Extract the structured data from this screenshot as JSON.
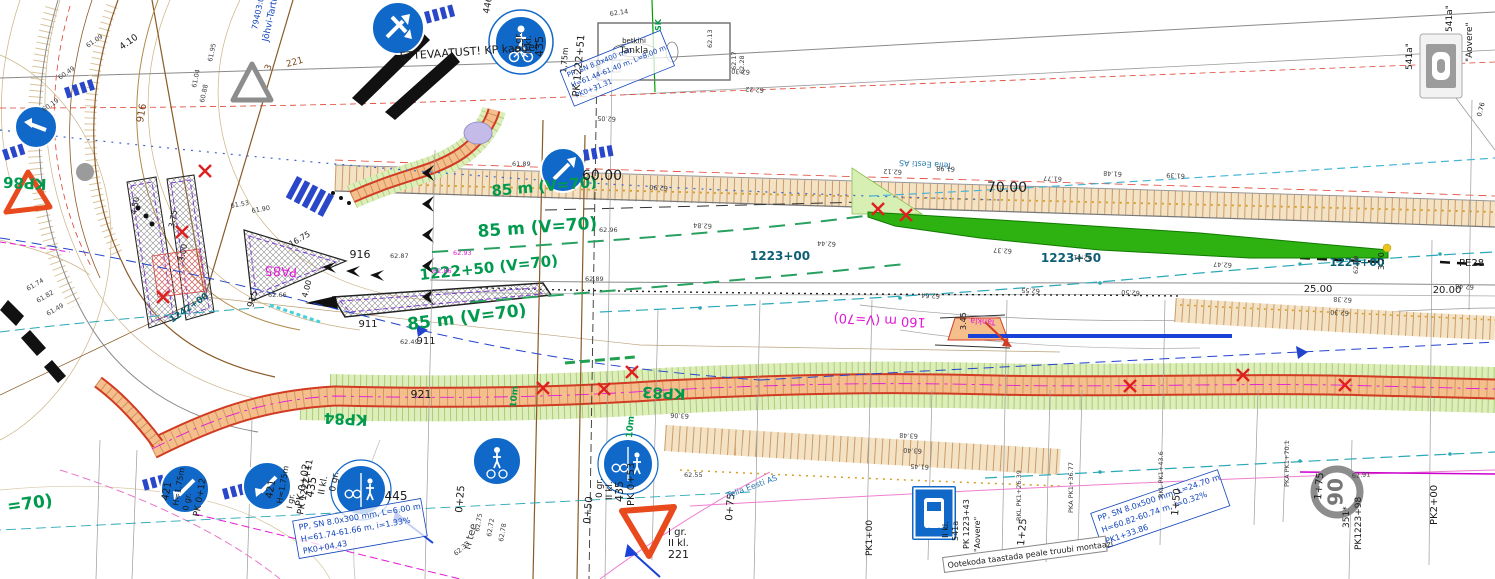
{
  "notes": {
    "caution_cable": "ETTEVAATUST! KP kaabel",
    "shelter": "Ootekoda taastada peale truubi montaazi",
    "gas_station_small": "betkini",
    "gas_station": "Tankla",
    "gas_station_inv": "Tankla",
    "road_name": "Jõhvi-Tartu-Valga",
    "cadastral_no": "79403:002:0",
    "street_fragment": "ri tee",
    "telia": "Telia Eesti AS",
    "sk_mark": "SK"
  },
  "curve_labels": [
    "85 m (V=70)",
    "85 m (V=70)",
    "1222+50 (V=70)",
    "85 m (V=70)",
    "160 m (V=70)",
    "=70)"
  ],
  "stations": {
    "a": "1223+00",
    "b": "1223+50",
    "c": "1224+00",
    "d": "1242+00",
    "pe28": "PE28"
  },
  "distances": {
    "d60": "60.00",
    "d70": "70.00",
    "d25": "25.00",
    "d20": "20.00"
  },
  "chainage": [
    "0+25",
    "0+50",
    "0+75",
    "1+25",
    "1+50",
    "1+75",
    "PK1+00",
    "PK2+00",
    "PK 1222+51"
  ],
  "km_posts": [
    "KP84",
    "KP83",
    "PA85",
    "KP86"
  ],
  "codes": [
    "916",
    "911",
    "915",
    "921",
    "911",
    "916",
    "446",
    "3",
    "221"
  ],
  "dims": [
    "4.10",
    "16.75",
    "4.00",
    "3.75",
    "4.50",
    "3.00",
    "3.45",
    "3.70",
    "10m",
    "10m",
    "1,75m",
    "0.76"
  ],
  "signs": {
    "s421_a": [
      "421",
      "H=1.75m",
      "0 gr.",
      "PK 0+12"
    ],
    "s421_b": [
      "421",
      "H=1.75m",
      "I gr.",
      "PK 1222+11"
    ],
    "s435_a": [
      "435",
      "II kl.",
      "0 gr.",
      "PK 0+02"
    ],
    "s435_b": [
      "0 gr.",
      "II kl.",
      "435",
      "PK 0+53"
    ],
    "s435_top": [
      "0 gr.",
      "II kl.",
      "435"
    ],
    "s445": "445",
    "s221": [
      "I gr.",
      "II kl.",
      "221"
    ],
    "s90": {
      "value": "90",
      "code": "351*",
      "pk": "PK1223+98"
    },
    "s541_right": {
      "c1": "541a\"",
      "c2": "541a\"",
      "name": "\"Aovere\""
    },
    "s541_bus": [
      "II kl.",
      "541a",
      "PK 1223+43",
      "\"Aovere\""
    ]
  },
  "pipes": {
    "p1": [
      "PP, SN 8.0x400 mm",
      "H=61.44-61.40 m, L=8.00 m",
      "PK0+31.31"
    ],
    "p2": [
      "PP, SN 8.0x300 mm, L=6.00 m",
      "H=61.74-61.66 m, i=1.33%",
      "PK0+04.43"
    ],
    "p3": [
      "PP, SN 8.0x500 mm, L=24.70 m",
      "H=60.82-60.74 m, i=0.32%",
      "PK1+33.86"
    ]
  },
  "section_markers": [
    "RKL PK1+26.39",
    "PKA PK1+36.77",
    "RKL PK1+43.6",
    "PKA PK1+70.1"
  ],
  "elevations": [
    "61.89",
    "62.90",
    "62.84",
    "62.96",
    "62.89",
    "62.05",
    "62.13",
    "62.17",
    "62.28",
    "62.30",
    "62.22",
    "62.14",
    "62.12",
    "61.98",
    "61.77",
    "61.48",
    "61.39",
    "62.37",
    "62.41",
    "62.47",
    "62.55",
    "62.50",
    "62.38",
    "62.30",
    "62.49",
    "62.46",
    "61.09",
    "60.49",
    "60.19",
    "61.04",
    "60.88",
    "61.95",
    "61.53",
    "61.90",
    "61.74",
    "61.82",
    "61.49",
    "62.87",
    "62.66",
    "62.86",
    "62.93",
    "62.49",
    "63.06",
    "62.55",
    "61.45",
    "63.48",
    "63.40",
    "62.75",
    "62.72",
    "62.78",
    "62.33",
    "62.91",
    "62.44",
    "62.64"
  ],
  "colors": {
    "sign_blue": "#1068c8",
    "road_orange": "#f5bf8d",
    "edge_red": "#d23b23",
    "green_area": "#2eb212",
    "label_green": "#009a4e",
    "station_teal": "#0c5f74",
    "magenta": "#e318d8",
    "pen_blue": "#1144bb",
    "warning_orange": "#e8491d"
  }
}
